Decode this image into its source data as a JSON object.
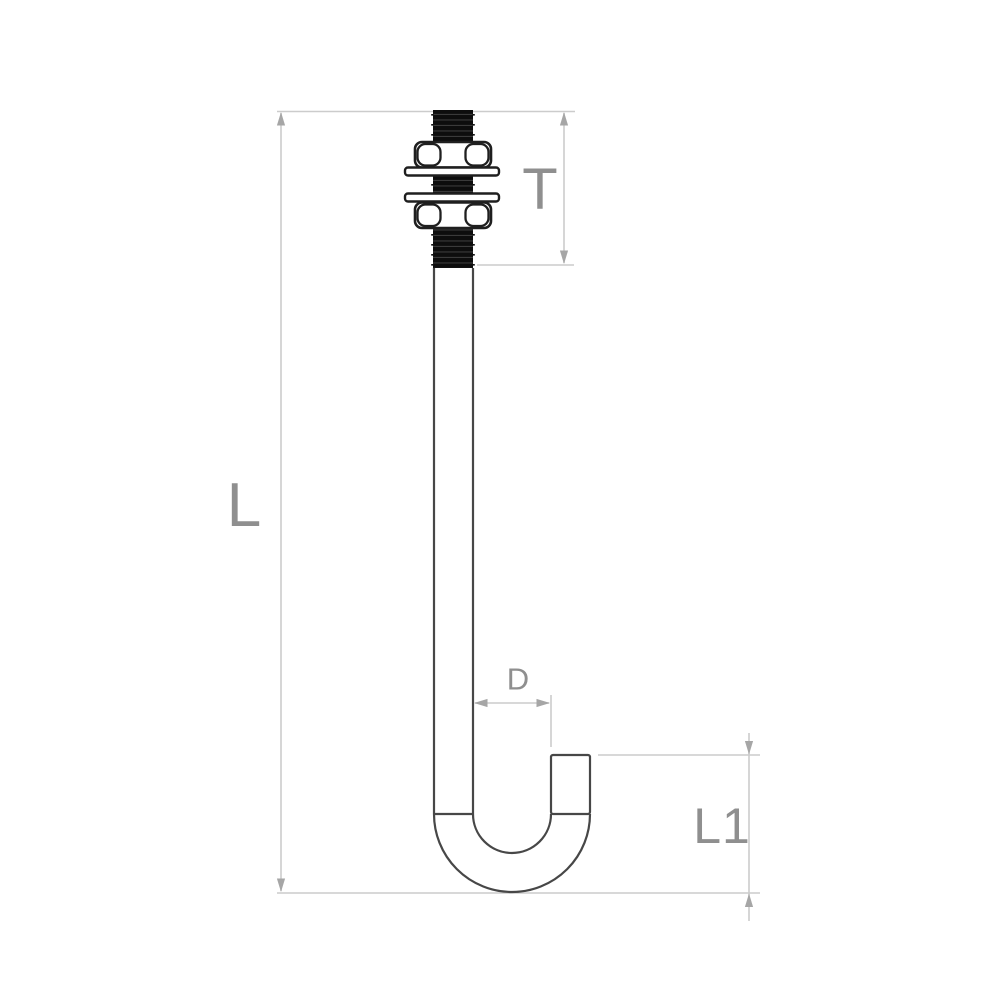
{
  "drawing": {
    "subject": "j-bolt-with-two-hex-nuts-and-two-washers",
    "labels": {
      "overall_length": "L",
      "thread_length": "T",
      "hook_inner_diameter": "D",
      "hook_opening_height": "L1"
    },
    "colors": {
      "background": "#ffffff",
      "part_outline": "#474747",
      "hardware_outline": "#1f1f1f",
      "thread_fill": "#0d0d0d",
      "dimension_line": "#cccccc",
      "dimension_arrow": "#a6a6a6",
      "dimension_text": "#8f8f8f"
    }
  }
}
